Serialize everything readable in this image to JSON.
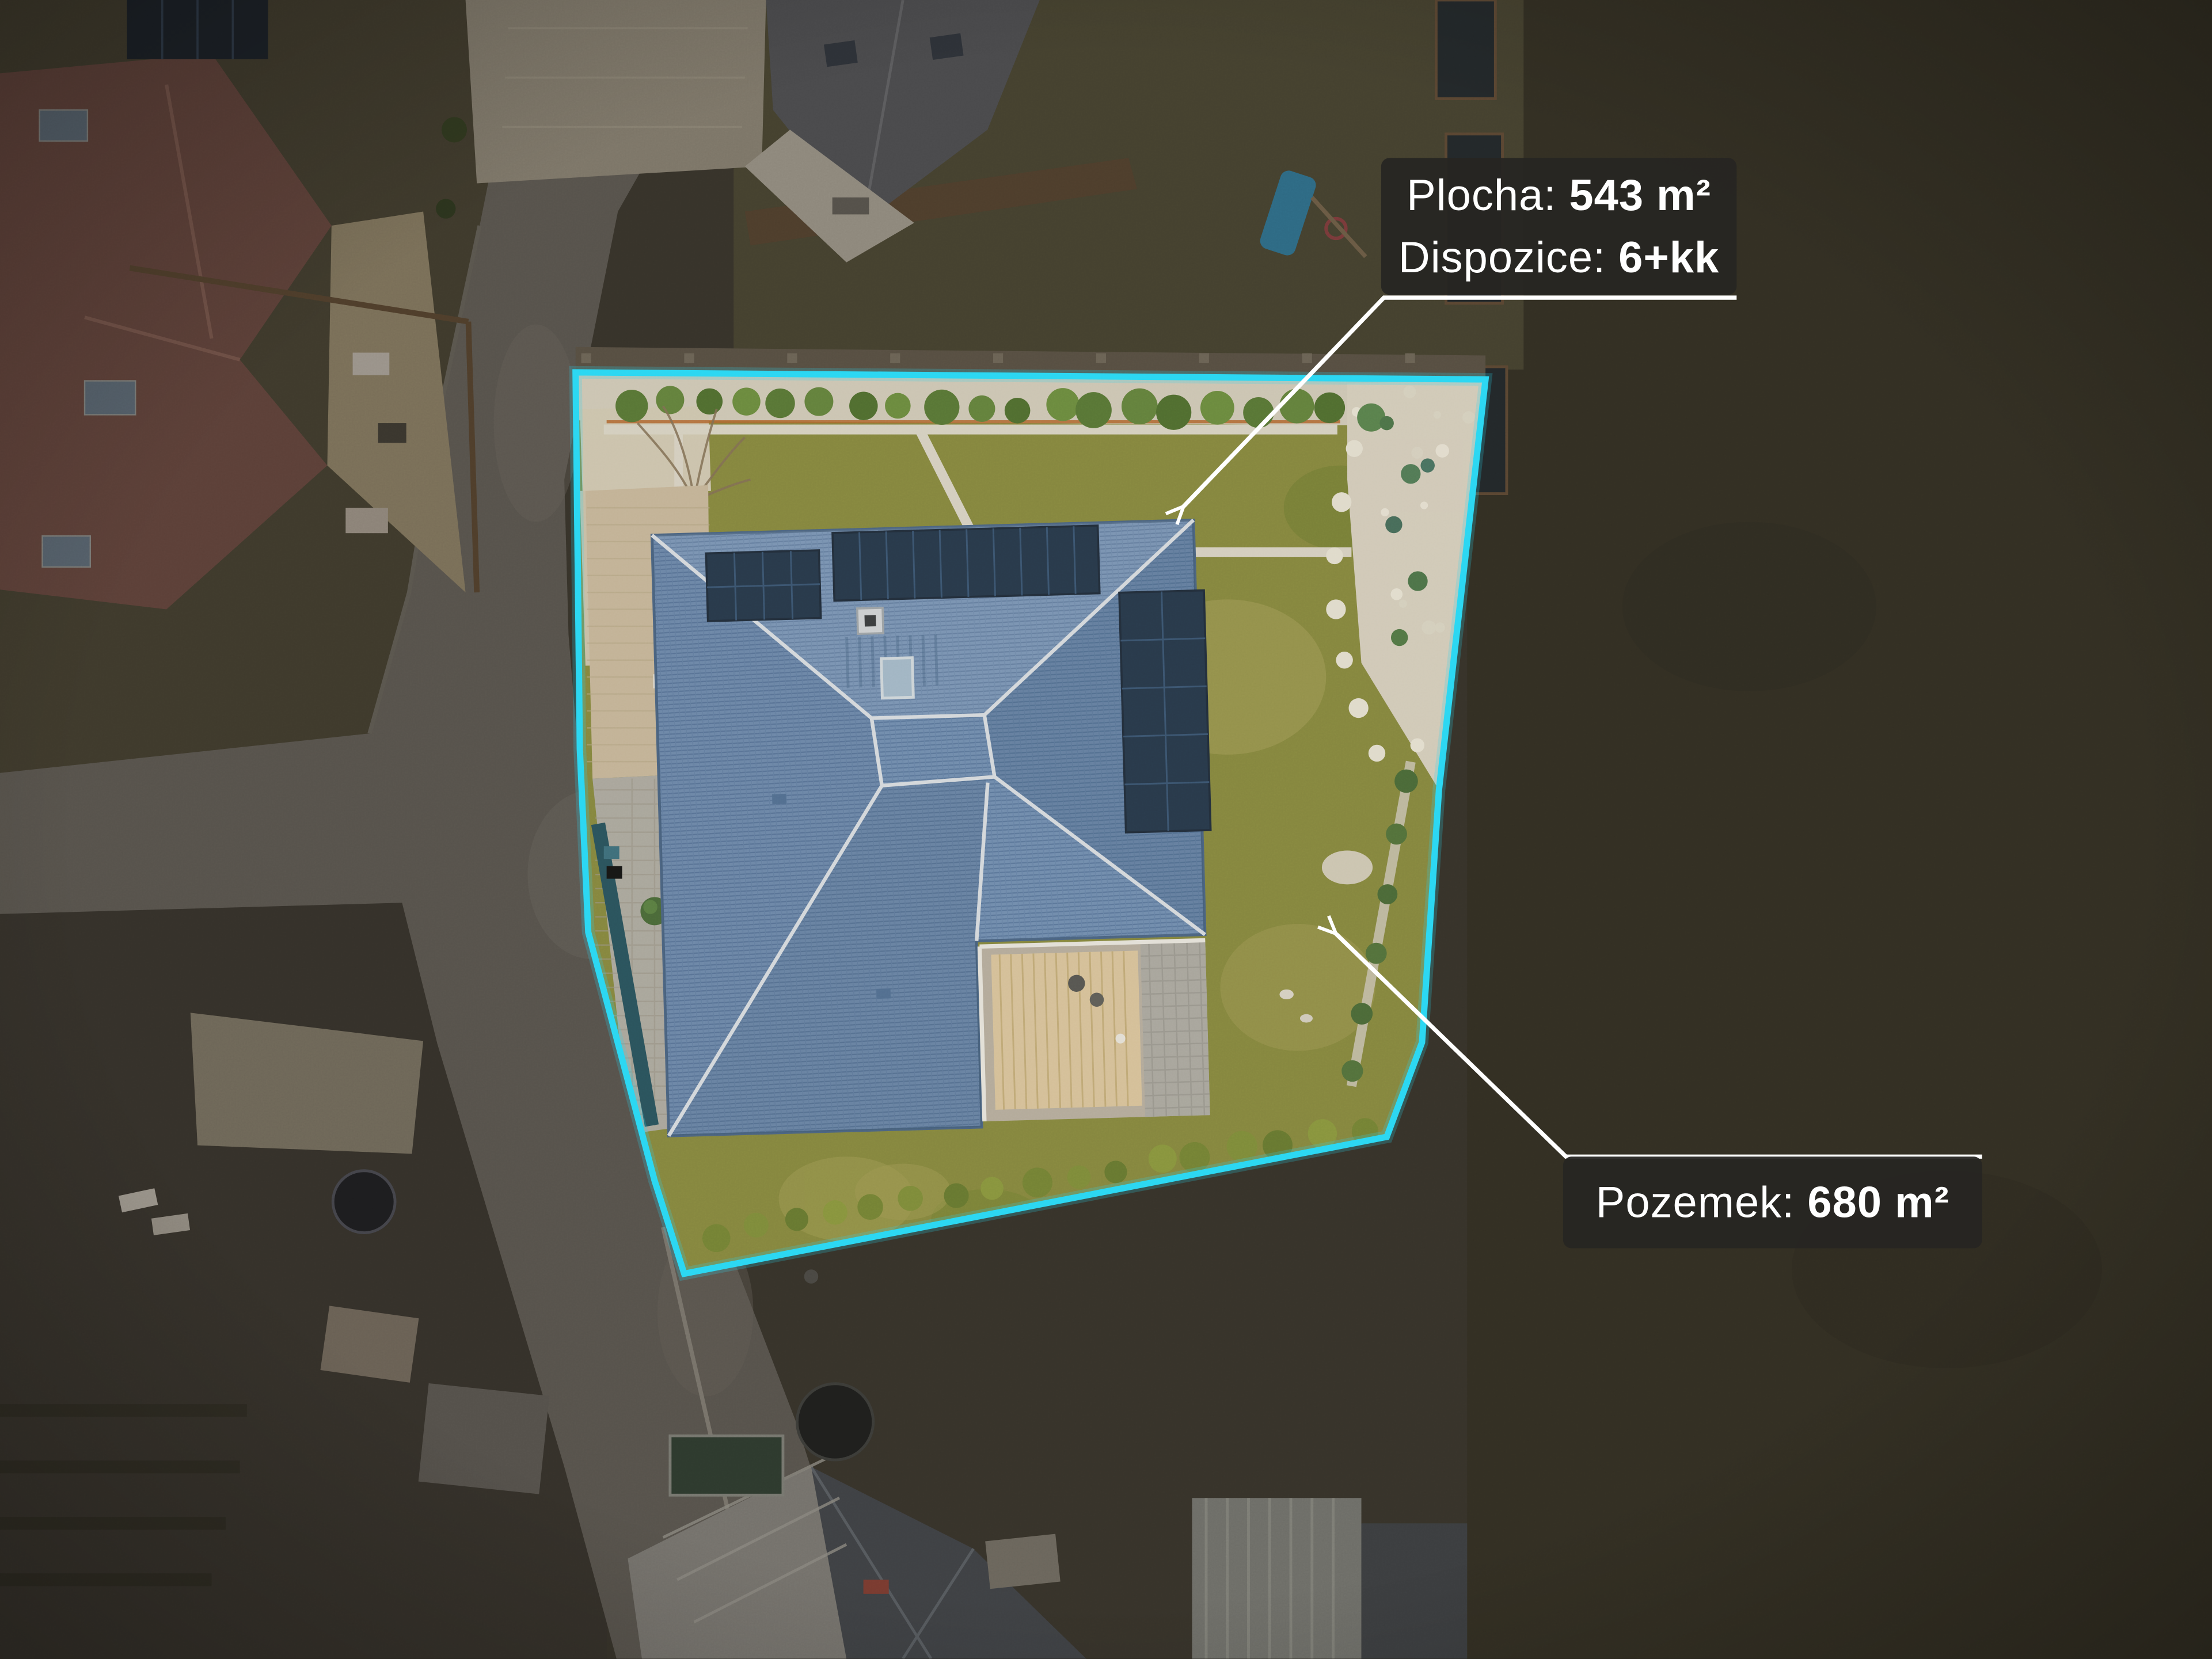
{
  "scene": {
    "subject": "aerial drone photo of a family house plot",
    "highlight": "property outlined in cyan, surroundings dimmed",
    "features": [
      "blue-hip-roof-house",
      "solar-panels",
      "chimney",
      "skylight",
      "terrace",
      "paver-driveway",
      "thuja-hedge",
      "gravel-rock-garden",
      "lawn",
      "street",
      "neighbor-houses"
    ]
  },
  "annotations": {
    "area": {
      "prefix": "Plocha:",
      "value": "543 m²"
    },
    "disposition": {
      "prefix": "Dispozice:",
      "value": "6+kk"
    },
    "plot": {
      "prefix": "Pozemek:",
      "value": "680 m²"
    }
  },
  "colors": {
    "boundary": "#2bd7f2",
    "leader_line": "#ffffff",
    "label_background": "rgba(38,37,34,0.94)",
    "label_text": "#ffffff",
    "roof": "#6887ae",
    "solar_panel": "#14283e",
    "lawn": "#7f8030",
    "gravel": "#d2cab7",
    "road": "#57534c"
  }
}
